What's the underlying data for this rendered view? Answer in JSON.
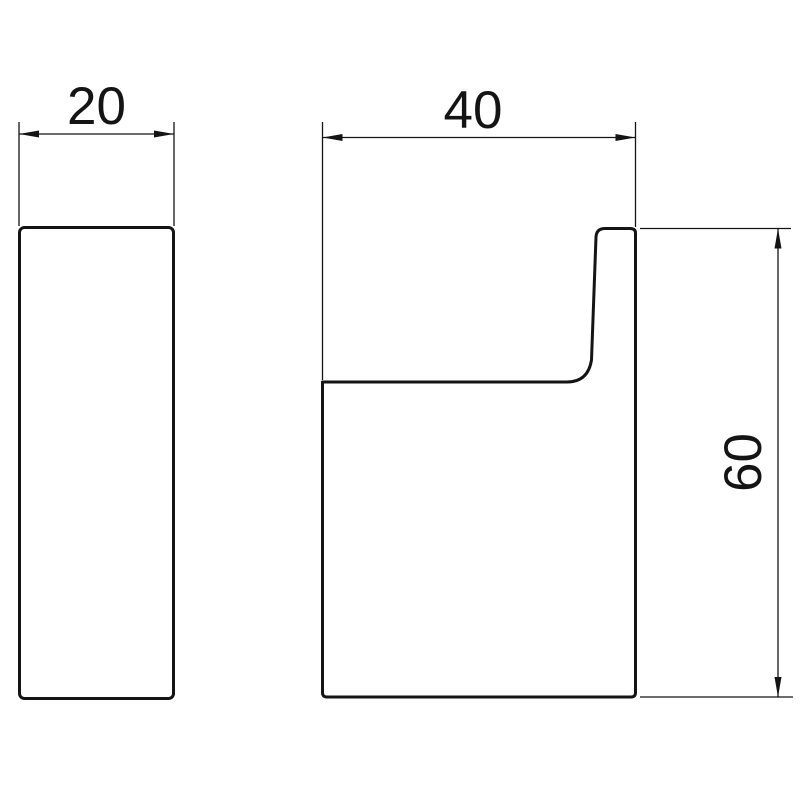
{
  "drawing": {
    "type": "technical-dimension-drawing",
    "background_color": "#ffffff",
    "line_color": "#141414",
    "views": {
      "side": {
        "width_label": "20"
      },
      "front": {
        "width_label": "40",
        "height_label": "60"
      }
    }
  }
}
